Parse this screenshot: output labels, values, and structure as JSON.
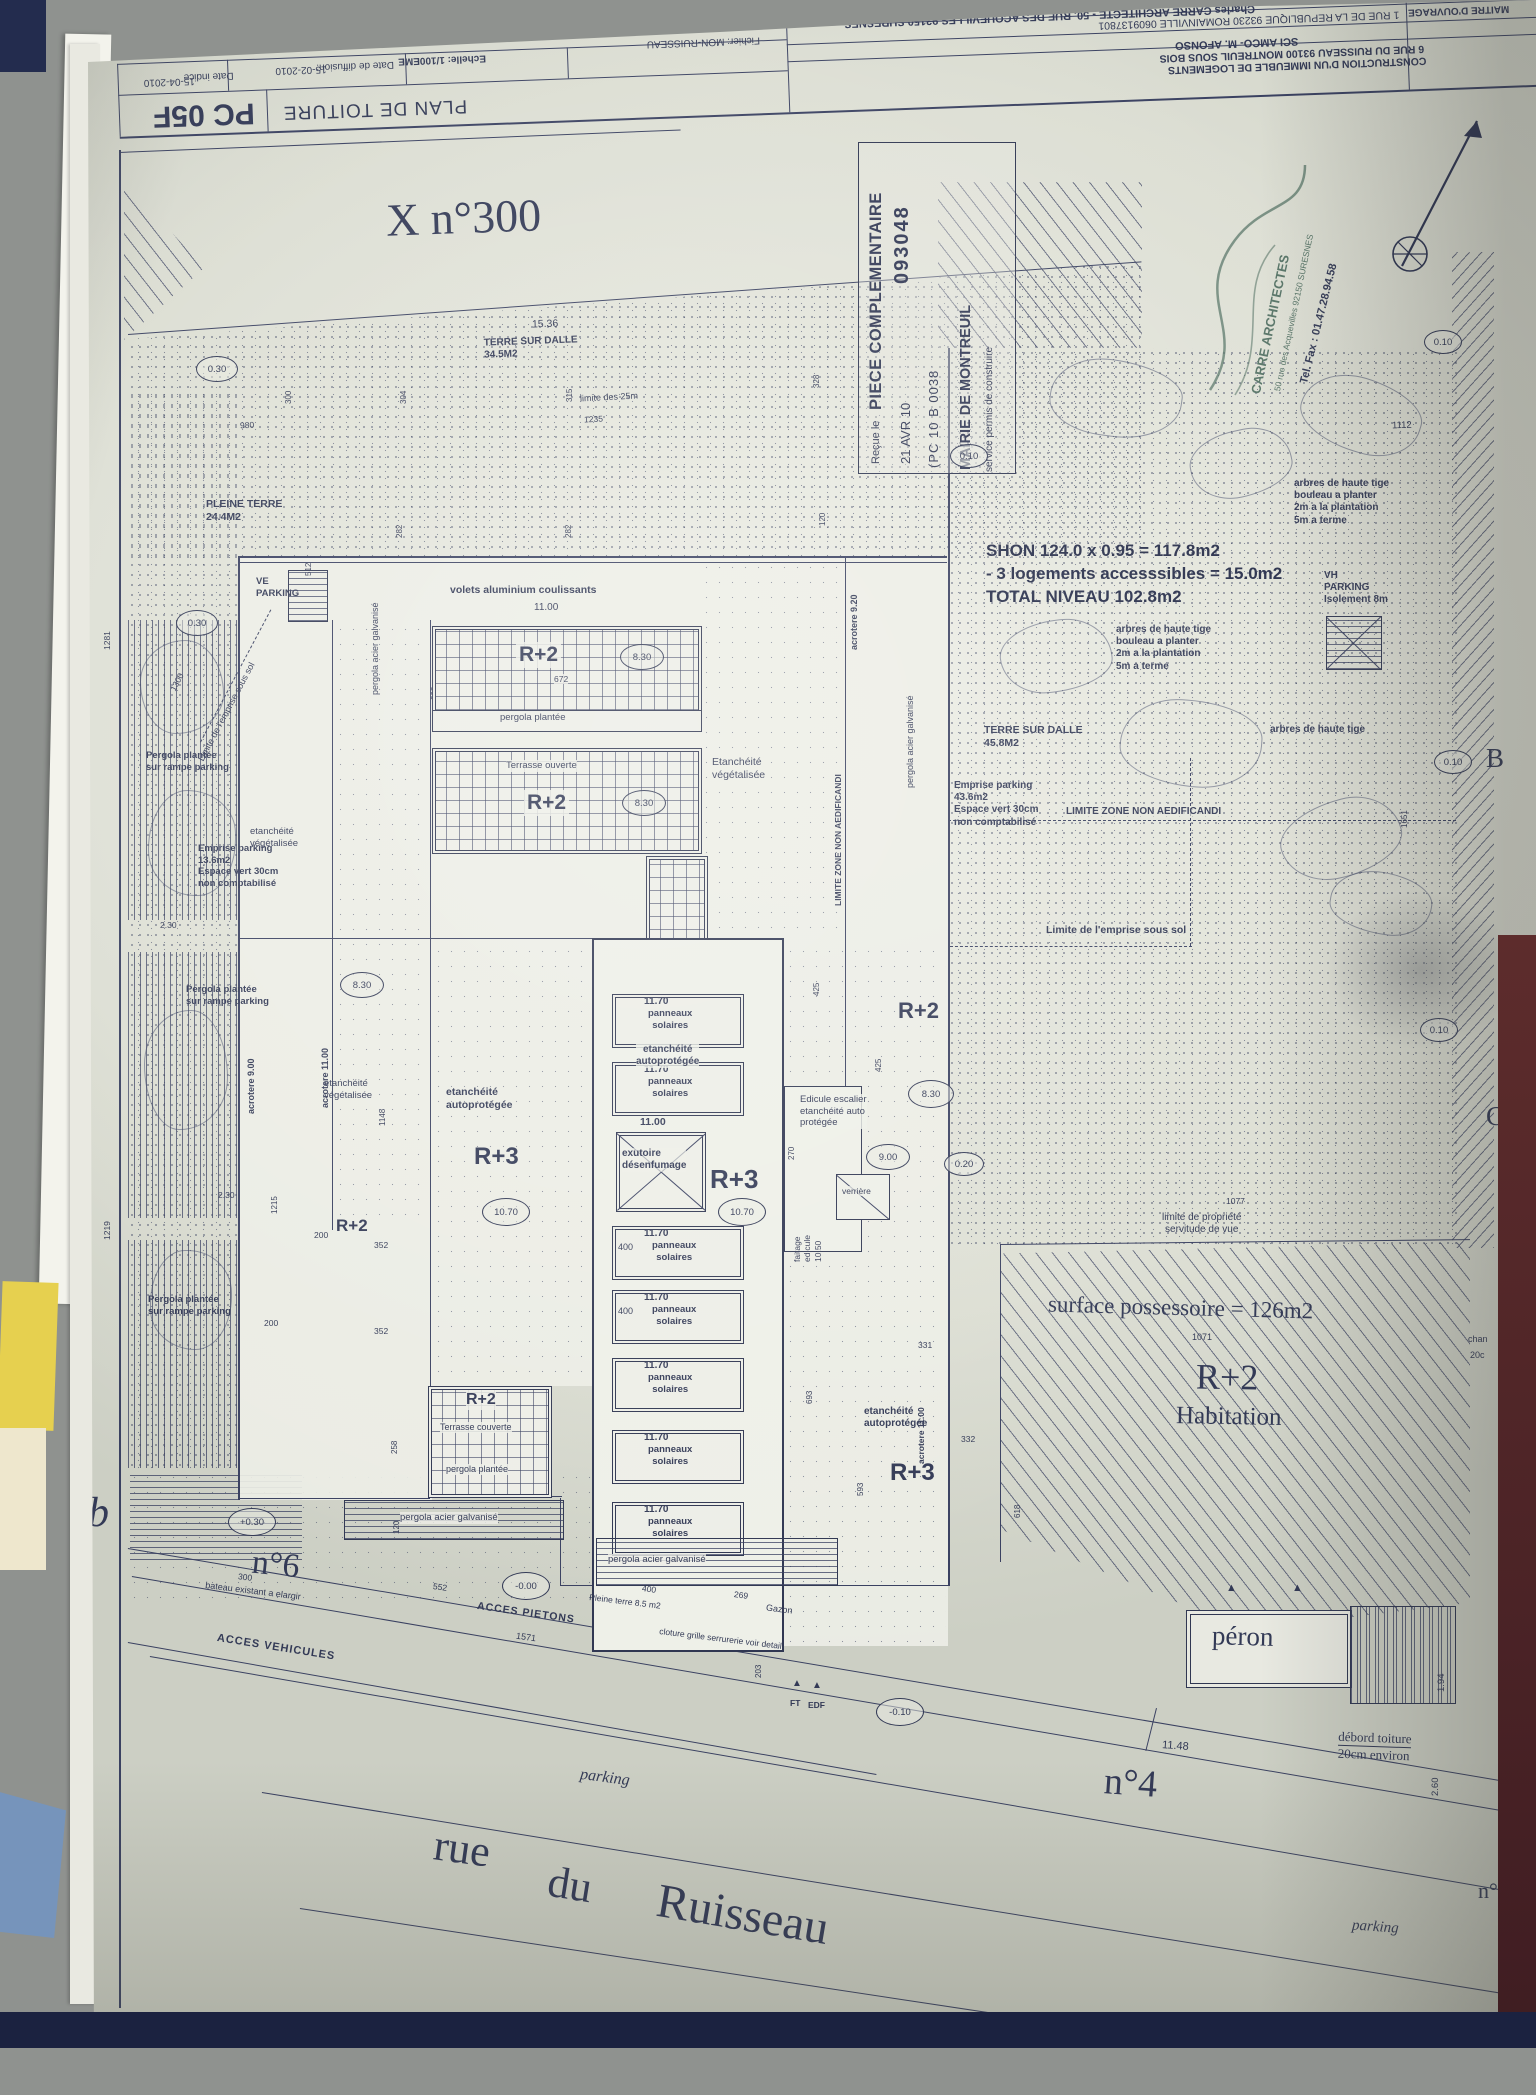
{
  "colors": {
    "paper": "#e3e4dc",
    "ink": "#333a56",
    "folder_blue": "#7694bb",
    "sticky_yellow": "#e6d04f",
    "navy_strip": "#1b2240",
    "maroon_strip": "#582a2b",
    "stamp_green": "#587568"
  },
  "title_block": {
    "project_line1": "CONSTRUCTION D'UN IMMEUBLE DE LOGEMENTS",
    "project_line2": "6 RUE DU RUISSEAU 93100 MONTREUIL SOUS BOIS",
    "moa_label": "MAITRE D'OUVRAGE",
    "moa_name": "SCI AMCO- M. AFONSO",
    "moa_address": "1 RUE DE LA REPUBLIQUE 93230 ROMAINVILLE 0609137801",
    "architect_label": "ARCHITECTE",
    "architect_name": "Charles CARRE ARCHITECTE - 50, RUE DES ACQUEVILLES 92150 SURESNES",
    "architect_tel": "TEL FAX 06 50 82 60 93",
    "sheet_title": "PLAN DE TOITURE",
    "scale": "Echelle: 1/100EME",
    "diffusion_label": "Date de diffusion:",
    "diffusion_date": "15-02-2010",
    "indice_label": "Date indice",
    "indice_date": "15-04-2010",
    "file": "Fichier: MON-RUISSEAU",
    "code": "PC 05F"
  },
  "stamp": {
    "line1": "PIECE COMPLEMENTAIRE",
    "number": "093048",
    "recue": "Reçue le",
    "date": "21 AVR 10",
    "ref": "(PC 10 B 0038",
    "authority": "MAIRIE DE MONTREUIL",
    "service": "service permis de construire"
  },
  "architect_stamp": {
    "name": "CARRE ARCHITECTES",
    "address": "50 rue des Acquevilles 92150 SURESNES",
    "tel": "Tel. Fax : 01.47.28.94.58"
  },
  "plan": {
    "title": "X n°300",
    "shon_line1": "SHON 124.0 x 0.95 = 117.8m2",
    "shon_line2": "- 3 logements accesssibles = 15.0m2",
    "shon_line3": "TOTAL NIVEAU 102.8m2",
    "levels": {
      "r2": "R+2",
      "r3": "R+3",
      "habitation": "Habitation"
    },
    "labels": {
      "terre_sur_dalle": "TERRE SUR DALLE",
      "a345": "34.5M2",
      "a458": "45.8M2",
      "limite_25m": "limite des 25m",
      "pleine_terre": "PLEINE TERRE",
      "a244": "24.4M2",
      "ve": "VE",
      "vh": "VH",
      "parking": "PARKING",
      "isolement": "Isolement 8m",
      "volets": "volets aluminium coulissants",
      "pergola_plantee": "pergola plantée",
      "pergola_plantee_cap": "Pergola plantée",
      "sur_rampe_parking": "sur rampe parking",
      "terrasse_ouverte": "Terrasse ouverte",
      "terrasse_couverte": "Terrasse couverte",
      "etancheite": "etanchéité",
      "etancheite_cap": "Etanchéité",
      "vegetalisee": "végétalisée",
      "autoprotegee": "autoprotégée",
      "arbres": "arbres de haute tige",
      "bouleau": "bouleau a planter",
      "plantation_2m": "2m a la plantation",
      "terme_5m": "5m a terme",
      "emprise_parking": "Emprise parking",
      "a436": "43.6m2",
      "a136": "13.6m2",
      "espace_vert": "Espace vert 30cm",
      "non_comptabilise": "non comptabilisé",
      "limite_zone": "LIMITE ZONE NON AEDIFICANDI",
      "limite_emprise": "Limite de l'emprise sous sol",
      "limite_propriete": "limite de propriété",
      "servitude_vue": "servitude de vue",
      "acrotere_900": "acrotere 9.00",
      "acrotere_920": "acrotere 9.20",
      "acrotere_1100": "acrotere 11.00",
      "panneaux": "panneaux",
      "solaires": "solaires",
      "h1170": "11.70",
      "h1100": "11.00",
      "exutoire": "exutoire",
      "desenfumage": "désenfumage",
      "edicule_l1": "Edicule escalier",
      "edicule_l2": "etanchéité auto",
      "edicule_l3": "protégée",
      "faitage": "faitage",
      "edicule": "edicule",
      "f1050": "10.50",
      "verriere": "verrière",
      "pergola_acier": "pergola acier galvanisé",
      "surface_possessoire": "surface possessoire = 126m2",
      "n6": "n°6",
      "n4": "n°4",
      "n_partial": "n°",
      "bateau": "bateau existant a elargir",
      "acces_pietons": "ACCES PIETONS",
      "acces_vehicules": "ACCES VEHICULES",
      "pleine_terre_85": "Pleine terre 8.5 m2",
      "gazon": "Gazon",
      "cloture": "cloture grille serrurerie voir detail",
      "ft": "FT",
      "edf": "EDF",
      "peron": "péron",
      "debord_l1": "débord toiture",
      "debord_l2": "20cm environ",
      "rue": "rue",
      "du": "du",
      "ruisseau": "Ruisseau",
      "parking_small": "parking",
      "margin_b": "B",
      "margin_c": "C",
      "margin_script": "b",
      "chan": "chan",
      "c20": "20c"
    },
    "circled": {
      "v030": "0.30",
      "v010": "0.10",
      "v830": "8.30",
      "v1070": "10.70",
      "v900": "9.00",
      "v020": "0.20",
      "vp030": "+0.30",
      "vm000": "-0.00",
      "vm010": "-0.10"
    },
    "dims": {
      "d980": "980",
      "d300": "300",
      "d304": "304",
      "d315": "315",
      "d282": "282",
      "d512": "512",
      "d328": "328",
      "d120": "120",
      "d203": "203",
      "d672": "672",
      "d325": "325",
      "d608": "608",
      "d1235": "1235",
      "d1536": "15.36",
      "d1112": "1112",
      "d1651": "1651",
      "d1281": "1281",
      "d1219": "1219",
      "d1300": "1300",
      "d230": "2.30",
      "d1215": "1215",
      "d200": "200",
      "d352": "352",
      "d258": "258",
      "d1148": "1148",
      "d400": "400",
      "d425": "425",
      "d270": "270",
      "d552": "552",
      "d1571": "1571",
      "d269": "269",
      "d331": "331",
      "d332": "332",
      "d593": "593",
      "d618": "618",
      "d693": "693",
      "d1071": "1071",
      "d1077": "1077",
      "d1148m": "11.48",
      "d194": "1.94",
      "d260": "2.60"
    }
  }
}
